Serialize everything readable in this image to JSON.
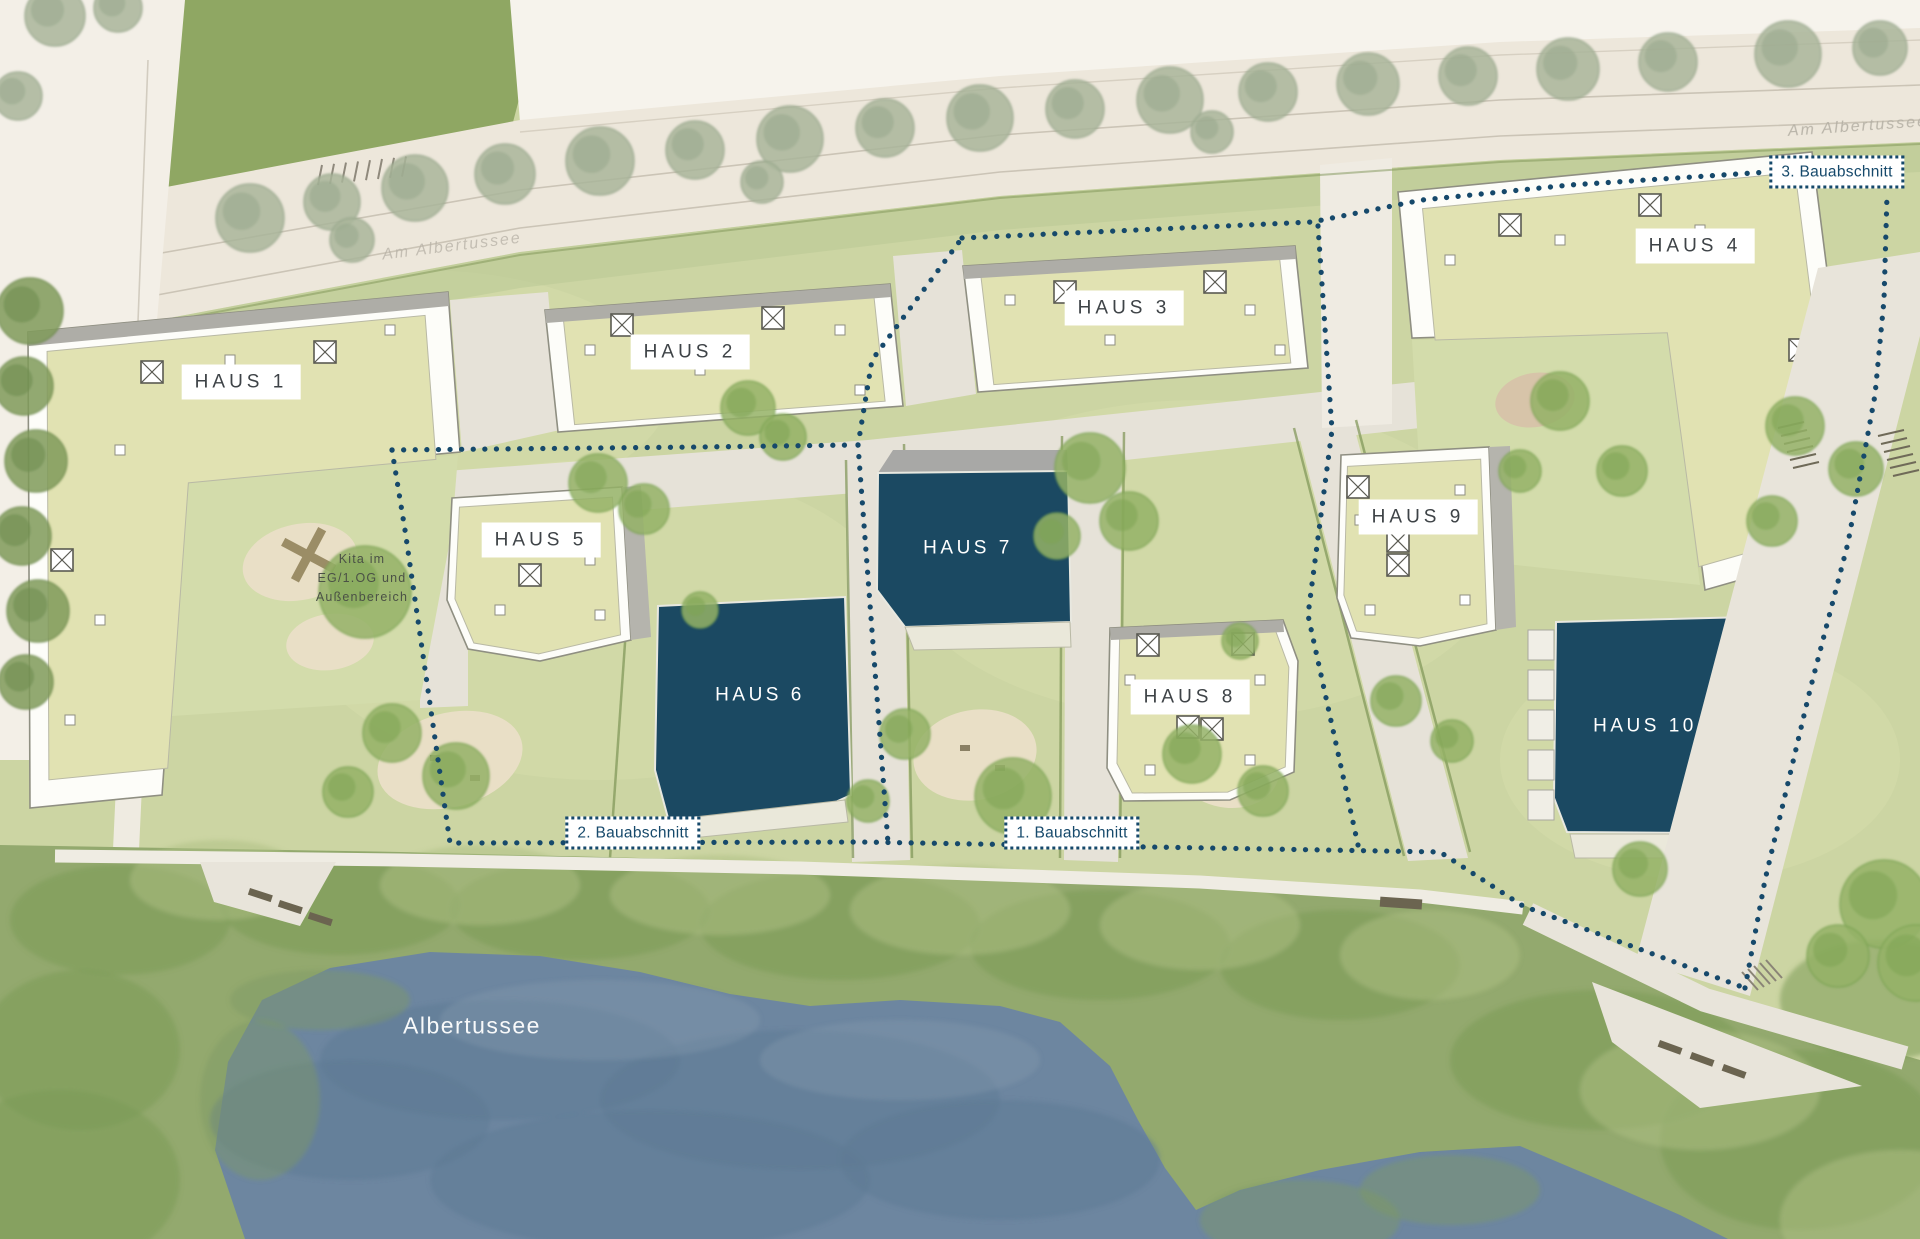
{
  "buildings": [
    {
      "id": "haus-1",
      "label": "HAUS 1",
      "marker": "light"
    },
    {
      "id": "haus-2",
      "label": "HAUS 2",
      "marker": "light"
    },
    {
      "id": "haus-3",
      "label": "HAUS 3",
      "marker": "light"
    },
    {
      "id": "haus-4",
      "label": "HAUS 4",
      "marker": "light"
    },
    {
      "id": "haus-5",
      "label": "HAUS 5",
      "marker": "light"
    },
    {
      "id": "haus-6",
      "label": "HAUS 6",
      "marker": "dark"
    },
    {
      "id": "haus-7",
      "label": "HAUS 7",
      "marker": "dark"
    },
    {
      "id": "haus-8",
      "label": "HAUS 8",
      "marker": "light"
    },
    {
      "id": "haus-9",
      "label": "HAUS 9",
      "marker": "light"
    },
    {
      "id": "haus-10",
      "label": "HAUS 10",
      "marker": "dark"
    }
  ],
  "phases": [
    {
      "label": "1. Bauabschnitt"
    },
    {
      "label": "2. Bauabschnitt"
    },
    {
      "label": "3. Bauabschnitt"
    }
  ],
  "kita": {
    "line1": "Kita im",
    "line2": "EG/1.OG und",
    "line3": "Außenbereich"
  },
  "lake": {
    "label": "Albertussee"
  },
  "streets": [
    {
      "label": "Am Albertussee"
    },
    {
      "label": "Am Albertussee"
    }
  ],
  "colors": {
    "accent": "#16496b",
    "building_dark": "#1b4962",
    "water": "#6d86a0",
    "roof_green": "#e1e2b2",
    "label_text": "#3e4347"
  }
}
